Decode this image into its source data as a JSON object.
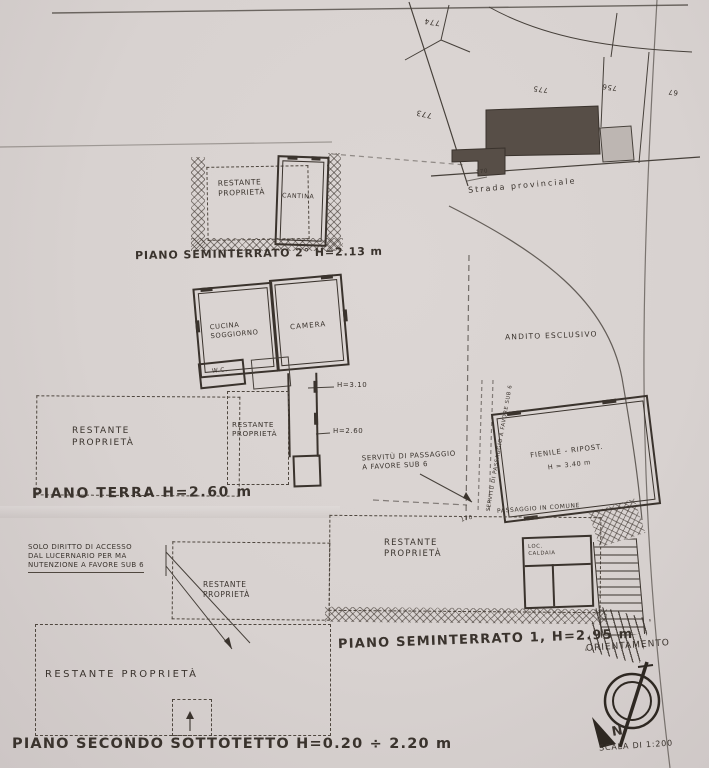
{
  "colors": {
    "paper": "#d8d2d0",
    "ink": "#3a332d",
    "building_fill": "#574e47"
  },
  "cadastral_map": {
    "street_label": "Strada provinciale",
    "parcel_774": "774",
    "parcel_773": "773",
    "parcel_775": "775",
    "parcel_756": "756",
    "parcel_67": "67",
    "road_marker": "170"
  },
  "plan_seminterrato_2": {
    "caption": "PIANO SEMINTERRATO 2° H=2.13 m",
    "room_restante": "RESTANTE\nPROPRIETÀ",
    "room_cantina": "CANTINA"
  },
  "plan_terra": {
    "caption": "PIANO TERRA H=2.60 m",
    "room_cucina": "CUCINA\nSOGGIORNO",
    "room_camera": "CAMERA",
    "room_wc": "W.C.",
    "restante_left": "RESTANTE\nPROPRIETÀ",
    "restante_right": "RESTANTE\nPROPRIETÀ",
    "height_1": "H=3.10",
    "height_2": "H=2.60"
  },
  "area_andito": {
    "label": "ANDITO ESCLUSIVO"
  },
  "plan_seminterrato_1": {
    "caption": "PIANO SEMINTERRATO 1, H=2.95 m",
    "room_fienile": "FIENILE - RIPOST.",
    "room_fienile_height": "H = 3.40 m",
    "servitu_note": "SERVITÙ DI PASSAGGIO\nA FAVORE SUB 6",
    "servitu_vertical": "SERVITÙ DI PASSAGGIO A FAVORE SUB 6",
    "passaggio_label": "PASSAGGIO IN COMUNE",
    "road_marker": "170",
    "restante": "RESTANTE\nPROPRIETÀ",
    "room_caldaia": "LOC.\nCALDAIA"
  },
  "plan_sottotetto": {
    "caption": "PIANO SECONDO SOTTOTETTO H=0.20 ÷ 2.20 m",
    "access_note": "SOLO DIRITTO DI ACCESSO\nDAL LUCERNARIO PER MA\nNUTENZIONE A FAVORE SUB 6",
    "restante_mid": "RESTANTE\nPROPRIETÀ",
    "restante_big": "RESTANTE PROPRIETÀ"
  },
  "orientation": {
    "title": "ORIENTAMENTO",
    "north": "N",
    "scale": "SCALA DI 1:200"
  }
}
